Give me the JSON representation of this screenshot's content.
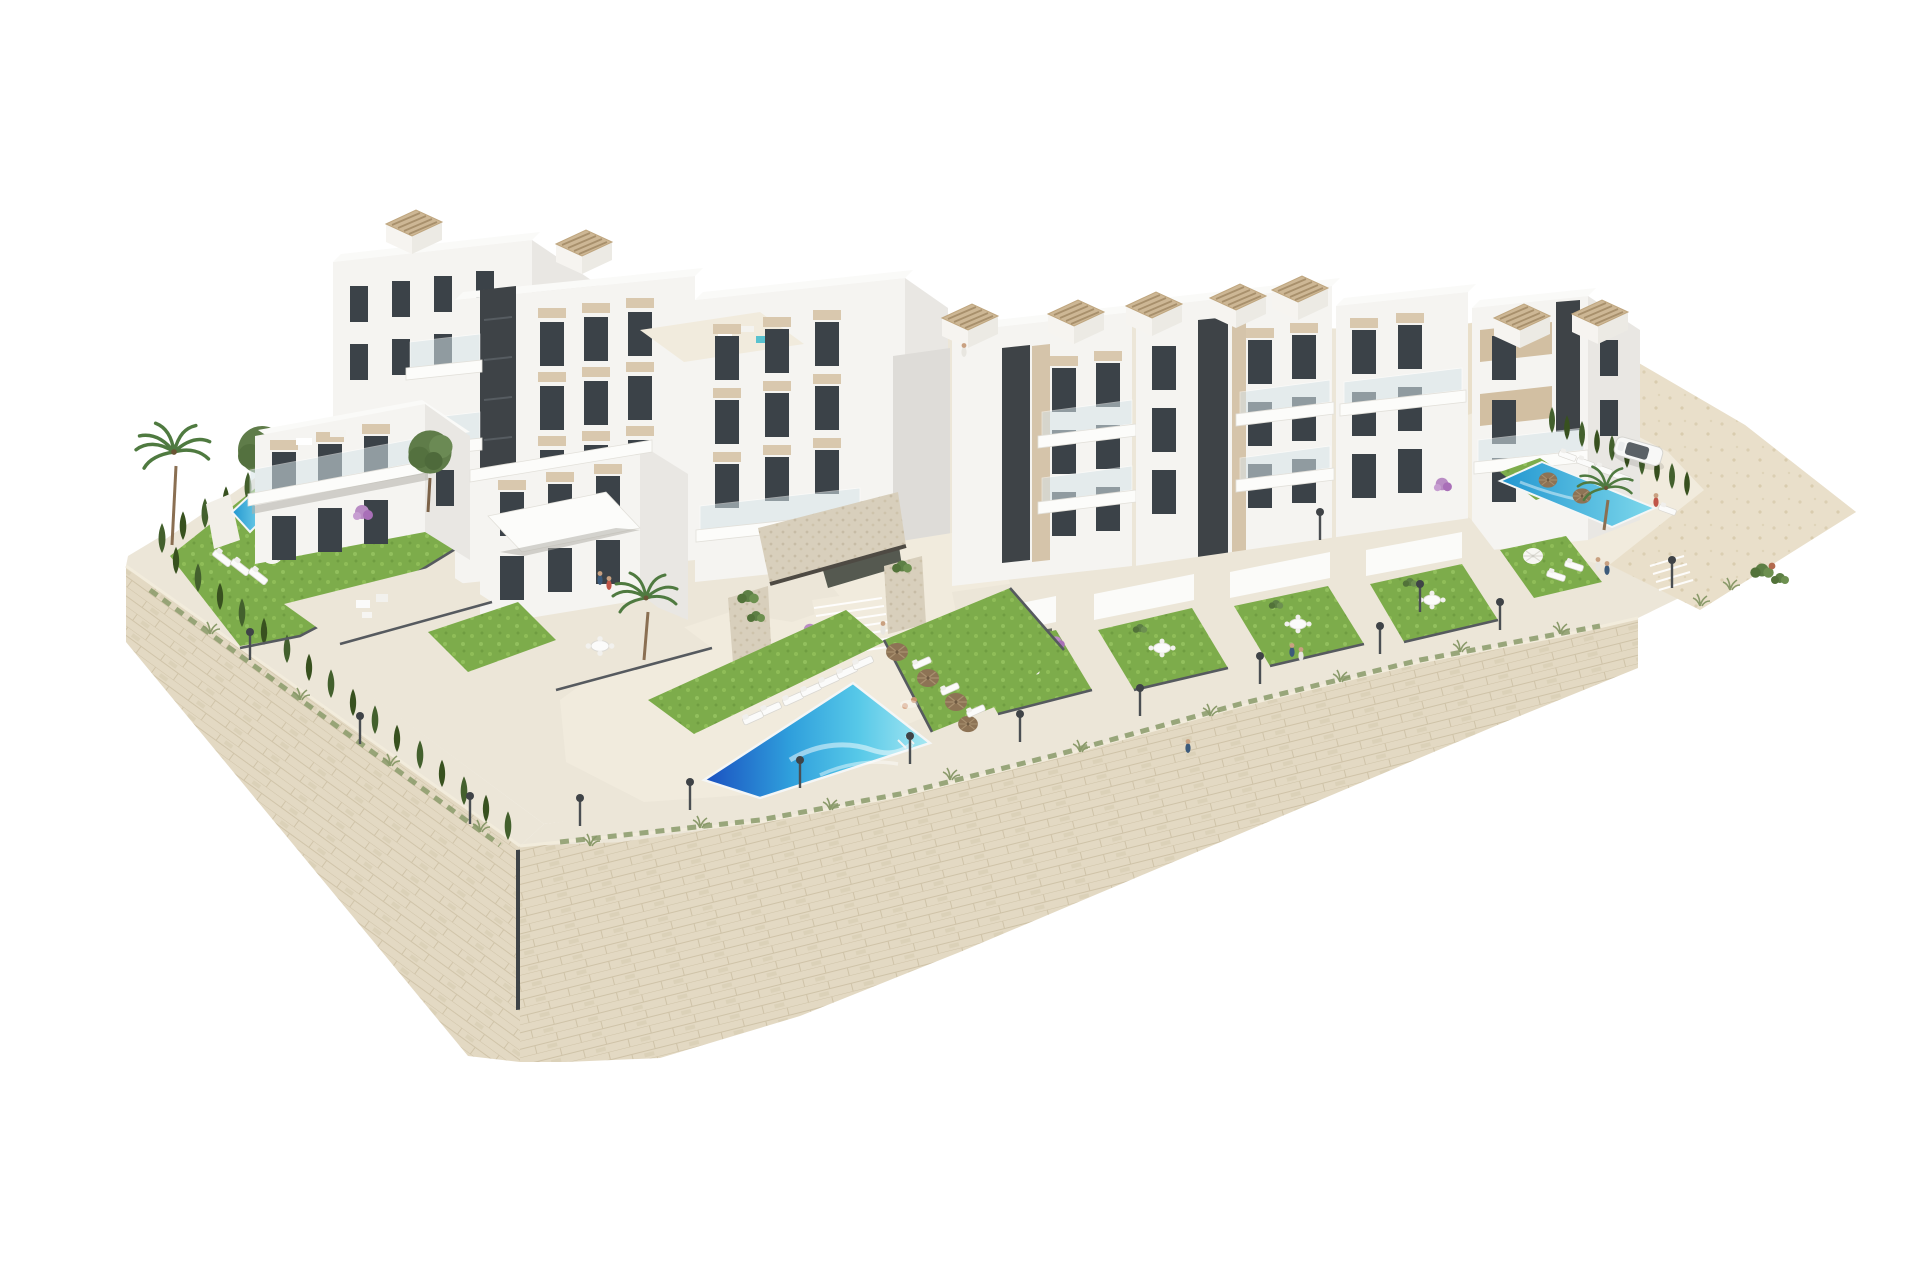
{
  "scene": {
    "setting": "Aerial 3D architectural render of a white hillside apartment complex with pools, gardens and stone retaining walls on a white background",
    "background": "#ffffff",
    "inventory": {
      "apartment_clusters": 2,
      "pools": [
        {
          "id": "central-community-pool"
        },
        {
          "id": "left-private-pool"
        },
        {
          "id": "right-community-pool"
        }
      ],
      "roof_pergolas": 9,
      "tan_umbrellas": 6,
      "white_umbrellas": 2,
      "sun_loungers": 20,
      "street_lamps": 15,
      "people": 12,
      "cypress_trees": 39,
      "palm_trees": 2,
      "leafy_trees": 4,
      "garden_dining_sets": 5,
      "parked_cars": 1
    }
  },
  "palette": {
    "background": "#ffffff",
    "stone_wall": "#e3d9c3",
    "paving": "#ece6d8",
    "lawn": "#7dac4b",
    "pool_deep": "#1a4fc0",
    "pool_mid": "#2f9fdc",
    "pool_aqua": "#56c8e8",
    "pool_pale": "#a8e8f2",
    "facade_white": "#f5f4f1",
    "accent_beige": "#d9c8ae",
    "dark_core": "#3e4347",
    "hedge_green": "#43602d",
    "pergola_beige": "#cdb795",
    "umbrella_tan": "#8d7355"
  }
}
